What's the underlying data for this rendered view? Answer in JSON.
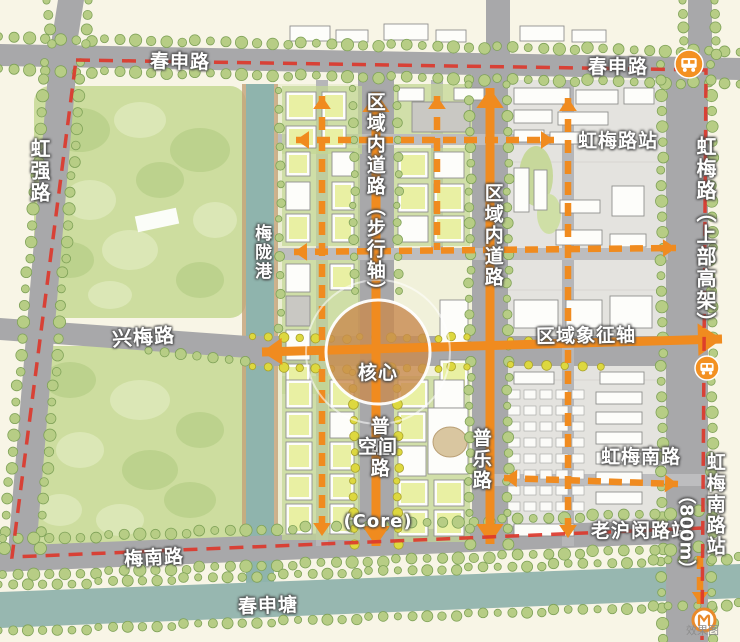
{
  "map": {
    "roads": {
      "chunshen": "春申路",
      "hongqiang": "虹强路",
      "xingmei": "兴梅路",
      "meinan": "梅南路",
      "hongmei_elevated": "虹梅路（上部高架）",
      "puwang": "普旺路",
      "pule": "普乐路",
      "internal_pedestrian": "区域内道路（步行轴）",
      "internal": "区域内道路"
    },
    "water": {
      "meilong_port": "梅陇港",
      "chunshen_canal": "春申塘"
    },
    "stations": {
      "top": {
        "line1": "春申路",
        "line2": "虹梅路站"
      },
      "mid": {
        "line1": "虹梅南路",
        "line2": "老沪闵路站"
      },
      "south": {
        "name": "虹梅南路站",
        "distance": "（800m）"
      }
    },
    "axes": {
      "symbol": "区域象征轴"
    },
    "core": {
      "line1": "核心",
      "line2": "空间",
      "line3": "(Core)"
    },
    "watermark": "效果图",
    "icons": {
      "bus": "bus-icon",
      "metro": "metro-logo-icon"
    }
  },
  "colors": {
    "background": "#f8f5e6",
    "road": "#a8a8aa",
    "park": "#cddd9f",
    "water": "#8fb4ad",
    "district_gray": "#e4e3df",
    "axis_orange": "#f08b1f",
    "boundary_red": "#dc382c",
    "building_green": "#e9f0a3",
    "core_plaza": "#c8894f"
  }
}
